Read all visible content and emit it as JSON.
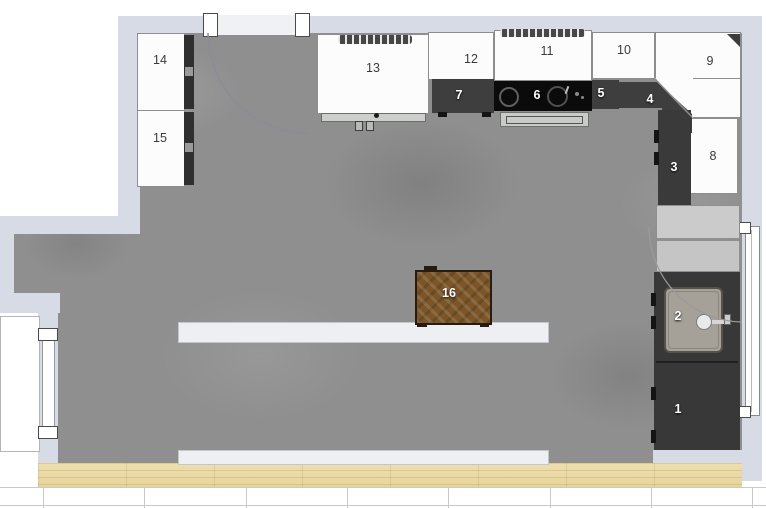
{
  "canvas": {
    "kind": "kitchen-floor-plan-top-view"
  },
  "colors": {
    "wall": "#d6dbe5",
    "floor_concrete": "#8f8f8f",
    "wood_floor": "#ecdca7",
    "cabinet_white": "#fcfcfc",
    "countertop_dark": "#3e3e3e",
    "cooktop_black": "#0b0b0b",
    "island_wood": "#7c5628",
    "fridge_gray": "#cbcbcb",
    "bar_light": "#edeff3",
    "label_dark": "#3a3a3a",
    "label_light": "#ffffff"
  },
  "items": [
    {
      "number": "1"
    },
    {
      "number": "2"
    },
    {
      "number": "3"
    },
    {
      "number": "4"
    },
    {
      "number": "5"
    },
    {
      "number": "6"
    },
    {
      "number": "7"
    },
    {
      "number": "8"
    },
    {
      "number": "9"
    },
    {
      "number": "10"
    },
    {
      "number": "11"
    },
    {
      "number": "12"
    },
    {
      "number": "13"
    },
    {
      "number": "14"
    },
    {
      "number": "15"
    },
    {
      "number": "16"
    }
  ]
}
